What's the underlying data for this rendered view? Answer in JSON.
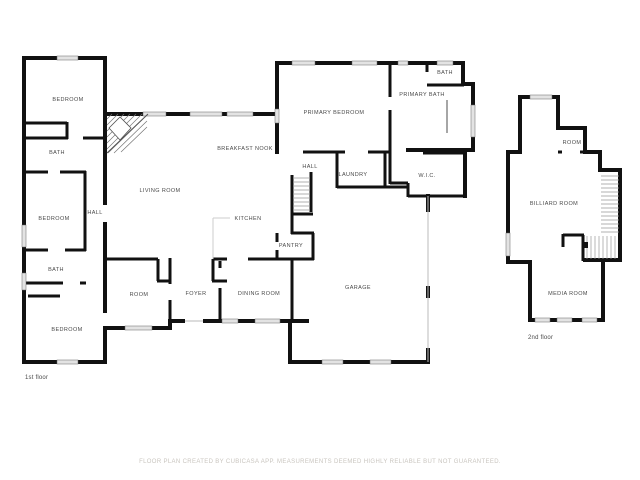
{
  "document_type": "floor-plan",
  "first_floor": {
    "floor_label": "1st floor",
    "rooms": {
      "bedroom_nw": "BEDROOM",
      "bath_upper": "BATH",
      "bedroom_w": "BEDROOM",
      "hall_west": "HALL",
      "bath_lower": "BATH",
      "bedroom_sw": "BEDROOM",
      "living_room": "LIVING ROOM",
      "breakfast_nook": "BREAKFAST NOOK",
      "kitchen": "KITCHEN",
      "hall_center": "HALL",
      "laundry": "LAUNDRY",
      "pantry": "PANTRY",
      "room": "ROOM",
      "foyer": "FOYER",
      "dining_room": "DINING ROOM",
      "garage": "GARAGE",
      "wic": "W.I.C.",
      "primary_bedroom": "PRIMARY BEDROOM",
      "primary_bath": "PRIMARY BATH",
      "bath_ne": "BATH"
    }
  },
  "second_floor": {
    "floor_label": "2nd floor",
    "rooms": {
      "room": "ROOM",
      "billiard_room": "BILLIARD ROOM",
      "media_room": "MEDIA ROOM"
    }
  },
  "footer": {
    "disclaimer": "FLOOR PLAN CREATED BY CUBICASA APP. MEASUREMENTS DEEMED HIGHLY RELIABLE BUT NOT GUARANTEED."
  },
  "colors": {
    "wall": "#111111",
    "window_fill": "#e3e3e3",
    "label_text": "#4a4a4a",
    "footer_text": "#c9c5bf",
    "background": "#ffffff"
  }
}
